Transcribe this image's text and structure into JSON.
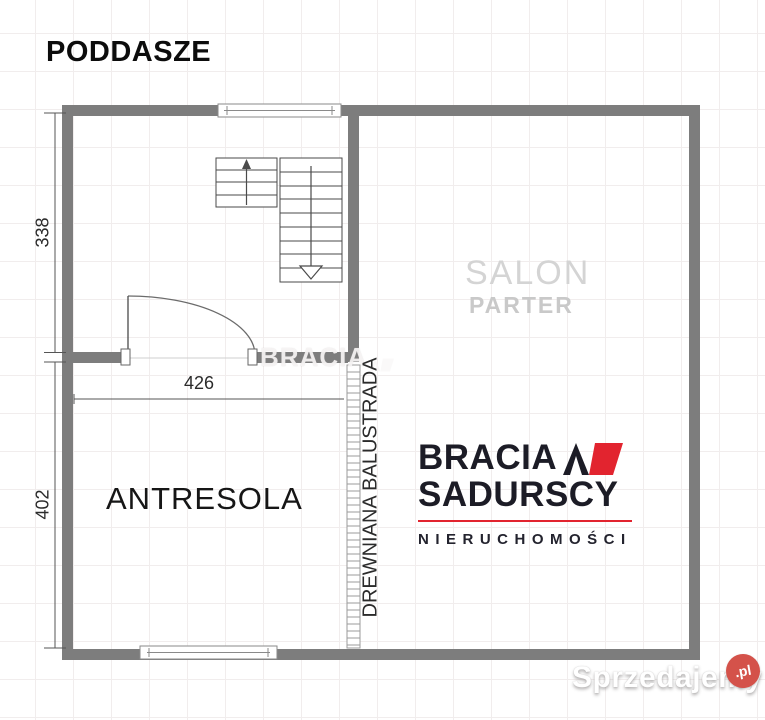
{
  "page": {
    "title": "PODDASZE"
  },
  "plan": {
    "room_labels": {
      "salon": "SALON",
      "salon_floor": "PARTER",
      "antresola": "ANTRESOLA",
      "balustrade": "DREWNIANA BALUSTRADA"
    },
    "dimensions": {
      "left_upper": "338",
      "left_lower": "402",
      "inner_width": "426"
    },
    "colors": {
      "wall": "#7d7d7d",
      "linework": "#4a4a4a",
      "grid": "#f1eded",
      "salon_text": "#d4d4d4",
      "parter_text": "#c9c9c9"
    }
  },
  "branding": {
    "center_watermark": "BRACIA",
    "logo": {
      "line1": "BRACIA",
      "line2": "SADURSCY",
      "tagline": "NIERUCHOMOŚCI",
      "accent_color": "#e2242f",
      "text_color": "#1c1c26"
    },
    "site_watermark": {
      "name": "Sprzedajemy",
      "tld": ".pl",
      "badge_color": "#d4524a"
    }
  }
}
